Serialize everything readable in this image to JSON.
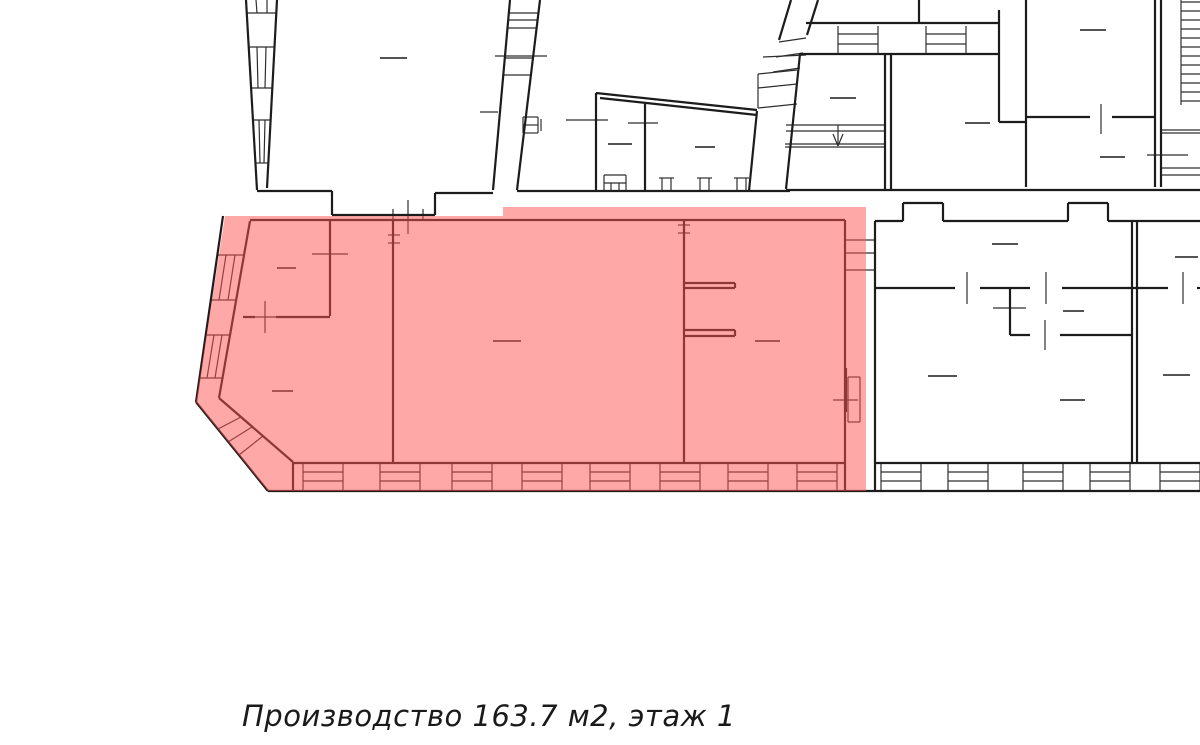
{
  "caption": {
    "text": "Производство 163.7 м2, этаж 1"
  },
  "colors": {
    "background": "#ffffff",
    "wall": "#1c1c1c",
    "thin_line": "#2e2e2e",
    "highlight": "#ff5252",
    "highlight_opacity": 0.5
  },
  "floorplan": {
    "width": 1200,
    "height": 745,
    "highlight_polygon": [
      [
        225,
        216
      ],
      [
        503,
        216
      ],
      [
        503,
        207
      ],
      [
        866,
        207
      ],
      [
        866,
        491
      ],
      [
        268,
        491
      ],
      [
        196,
        402
      ]
    ],
    "thick": [
      [
        246,
        0,
        257,
        190
      ],
      [
        277,
        0,
        267,
        188
      ],
      [
        257,
        191,
        332,
        191
      ],
      [
        332,
        191,
        332,
        215
      ],
      [
        332,
        215,
        435,
        215
      ],
      [
        435,
        215,
        435,
        193
      ],
      [
        435,
        193,
        493,
        193
      ],
      [
        510,
        0,
        493,
        190
      ],
      [
        540,
        0,
        517,
        190
      ],
      [
        517,
        191,
        790,
        191
      ],
      [
        596,
        93,
        596,
        191
      ],
      [
        596,
        93,
        757,
        110
      ],
      [
        600,
        98,
        757,
        115
      ],
      [
        645,
        104,
        645,
        191
      ],
      [
        757,
        111,
        749,
        191
      ],
      [
        800,
        54,
        786,
        189
      ],
      [
        885,
        54,
        885,
        189
      ],
      [
        891,
        54,
        891,
        189
      ],
      [
        806,
        23,
        999,
        23
      ],
      [
        800,
        54,
        999,
        54
      ],
      [
        919,
        0,
        919,
        23
      ],
      [
        999,
        10,
        999,
        122
      ],
      [
        999,
        122,
        1026,
        122
      ],
      [
        1026,
        0,
        1026,
        187
      ],
      [
        1026,
        117,
        1090,
        117
      ],
      [
        1112,
        117,
        1155,
        117
      ],
      [
        1155,
        0,
        1155,
        187
      ],
      [
        1161,
        0,
        1161,
        187
      ],
      [
        786,
        190,
        1200,
        190
      ],
      [
        791,
        0,
        779,
        40
      ],
      [
        818,
        0,
        807,
        35
      ],
      [
        875,
        221,
        903,
        221
      ],
      [
        903,
        221,
        903,
        203
      ],
      [
        903,
        203,
        943,
        203
      ],
      [
        943,
        203,
        943,
        221
      ],
      [
        943,
        221,
        1068,
        221
      ],
      [
        1068,
        221,
        1068,
        203
      ],
      [
        1068,
        203,
        1108,
        203
      ],
      [
        1108,
        203,
        1108,
        221
      ],
      [
        1108,
        221,
        1200,
        221
      ],
      [
        875,
        221,
        875,
        463
      ],
      [
        1132,
        221,
        1132,
        463
      ],
      [
        1137,
        221,
        1137,
        463
      ],
      [
        875,
        288,
        955,
        288
      ],
      [
        980,
        288,
        1030,
        288
      ],
      [
        1062,
        288,
        1168,
        288
      ],
      [
        1197,
        288,
        1200,
        288
      ],
      [
        1010,
        288,
        1010,
        335
      ],
      [
        1010,
        335,
        1030,
        335
      ],
      [
        1060,
        335,
        1132,
        335
      ],
      [
        250,
        220,
        845,
        220
      ],
      [
        250,
        221,
        219,
        398
      ],
      [
        219,
        398,
        293,
        462
      ],
      [
        293,
        462,
        293,
        491
      ],
      [
        293,
        463,
        845,
        463
      ],
      [
        875,
        463,
        1200,
        463
      ],
      [
        845,
        220,
        845,
        463
      ],
      [
        393,
        220,
        393,
        463
      ],
      [
        684,
        220,
        684,
        463
      ],
      [
        330,
        220,
        330,
        316
      ],
      [
        243,
        317,
        255,
        317
      ],
      [
        276,
        317,
        330,
        317
      ],
      [
        684,
        283,
        735,
        283
      ],
      [
        684,
        288,
        735,
        288
      ],
      [
        735,
        283,
        735,
        288
      ],
      [
        684,
        330,
        735,
        330
      ],
      [
        684,
        336,
        735,
        336
      ],
      [
        735,
        330,
        735,
        336
      ],
      [
        223,
        216,
        196,
        402
      ],
      [
        196,
        402,
        268,
        491
      ],
      [
        268,
        491,
        1200,
        491
      ],
      [
        845,
        463,
        845,
        491
      ],
      [
        875,
        463,
        875,
        491
      ],
      [
        846,
        368,
        846,
        412
      ]
    ],
    "thin": [
      [
        247,
        13,
        276,
        13
      ],
      [
        256,
        0,
        257,
        13
      ],
      [
        267,
        0,
        267,
        13
      ],
      [
        249,
        47,
        274,
        47
      ],
      [
        251,
        88,
        272,
        88
      ],
      [
        257,
        47,
        258,
        88
      ],
      [
        266,
        47,
        265,
        88
      ],
      [
        253,
        120,
        271,
        120
      ],
      [
        255,
        163,
        268,
        163
      ],
      [
        259,
        120,
        260,
        163
      ],
      [
        265,
        120,
        264,
        163
      ],
      [
        509,
        13,
        538,
        13
      ],
      [
        508,
        20,
        537,
        20
      ],
      [
        507,
        28,
        537,
        28
      ],
      [
        495,
        56,
        547,
        56
      ],
      [
        505,
        58,
        533,
        58
      ],
      [
        503,
        75,
        531,
        75
      ],
      [
        523,
        117,
        538,
        117
      ],
      [
        538,
        117,
        538,
        133
      ],
      [
        523,
        133,
        538,
        133
      ],
      [
        523,
        117,
        523,
        133
      ],
      [
        523,
        125,
        538,
        125
      ],
      [
        541,
        119,
        541,
        131
      ],
      [
        480,
        112,
        498,
        112
      ],
      [
        217,
        255,
        244,
        255
      ],
      [
        211,
        300,
        236,
        300
      ],
      [
        226,
        255,
        219,
        300
      ],
      [
        235,
        255,
        228,
        300
      ],
      [
        206,
        335,
        230,
        335
      ],
      [
        200,
        378,
        223,
        378
      ],
      [
        214,
        335,
        207,
        378
      ],
      [
        222,
        335,
        215,
        378
      ],
      [
        218,
        429,
        241,
        417
      ],
      [
        228,
        442,
        252,
        427
      ],
      [
        239,
        455,
        263,
        436
      ],
      [
        303,
        463,
        303,
        491
      ],
      [
        343,
        463,
        343,
        491
      ],
      [
        303,
        472,
        343,
        472
      ],
      [
        303,
        481,
        343,
        481
      ],
      [
        380,
        463,
        380,
        491
      ],
      [
        420,
        463,
        420,
        491
      ],
      [
        380,
        472,
        420,
        472
      ],
      [
        380,
        481,
        420,
        481
      ],
      [
        452,
        463,
        452,
        491
      ],
      [
        492,
        463,
        492,
        491
      ],
      [
        452,
        472,
        492,
        472
      ],
      [
        452,
        481,
        492,
        481
      ],
      [
        522,
        463,
        522,
        491
      ],
      [
        562,
        463,
        562,
        491
      ],
      [
        522,
        472,
        562,
        472
      ],
      [
        522,
        481,
        562,
        481
      ],
      [
        590,
        463,
        590,
        491
      ],
      [
        630,
        463,
        630,
        491
      ],
      [
        590,
        472,
        630,
        472
      ],
      [
        590,
        481,
        630,
        481
      ],
      [
        660,
        463,
        660,
        491
      ],
      [
        700,
        463,
        700,
        491
      ],
      [
        660,
        472,
        700,
        472
      ],
      [
        660,
        481,
        700,
        481
      ],
      [
        728,
        463,
        728,
        491
      ],
      [
        768,
        463,
        768,
        491
      ],
      [
        728,
        472,
        768,
        472
      ],
      [
        728,
        481,
        768,
        481
      ],
      [
        797,
        463,
        797,
        491
      ],
      [
        837,
        463,
        837,
        491
      ],
      [
        797,
        472,
        837,
        472
      ],
      [
        797,
        481,
        837,
        481
      ],
      [
        881,
        463,
        881,
        491
      ],
      [
        921,
        463,
        921,
        491
      ],
      [
        881,
        472,
        921,
        472
      ],
      [
        881,
        481,
        921,
        481
      ],
      [
        948,
        463,
        948,
        491
      ],
      [
        988,
        463,
        988,
        491
      ],
      [
        948,
        472,
        988,
        472
      ],
      [
        948,
        481,
        988,
        481
      ],
      [
        1023,
        463,
        1023,
        491
      ],
      [
        1063,
        463,
        1063,
        491
      ],
      [
        1023,
        472,
        1063,
        472
      ],
      [
        1023,
        481,
        1063,
        481
      ],
      [
        1090,
        463,
        1090,
        491
      ],
      [
        1130,
        463,
        1130,
        491
      ],
      [
        1090,
        472,
        1130,
        472
      ],
      [
        1090,
        481,
        1130,
        481
      ],
      [
        1160,
        463,
        1160,
        491
      ],
      [
        1200,
        463,
        1200,
        491
      ],
      [
        1160,
        472,
        1200,
        472
      ],
      [
        1160,
        481,
        1200,
        481
      ],
      [
        786,
        125,
        885,
        125
      ],
      [
        786,
        131,
        885,
        131
      ],
      [
        785,
        144,
        885,
        144
      ],
      [
        785,
        147,
        885,
        147
      ],
      [
        838,
        125,
        838,
        145
      ],
      [
        833,
        134,
        838,
        146
      ],
      [
        843,
        134,
        838,
        146
      ],
      [
        758,
        74,
        797,
        70
      ],
      [
        758,
        88,
        797,
        84
      ],
      [
        758,
        108,
        797,
        104
      ],
      [
        758,
        74,
        758,
        108
      ],
      [
        779,
        42,
        806,
        38
      ],
      [
        776,
        57,
        803,
        53
      ],
      [
        773,
        72,
        800,
        68
      ],
      [
        838,
        26,
        838,
        54
      ],
      [
        878,
        26,
        878,
        54
      ],
      [
        838,
        34,
        878,
        34
      ],
      [
        838,
        44,
        878,
        44
      ],
      [
        926,
        26,
        926,
        54
      ],
      [
        966,
        26,
        966,
        54
      ],
      [
        926,
        34,
        966,
        34
      ],
      [
        926,
        44,
        966,
        44
      ],
      [
        763,
        57,
        806,
        55
      ],
      [
        659,
        178,
        674,
        178
      ],
      [
        662,
        178,
        662,
        190
      ],
      [
        671,
        178,
        671,
        190
      ],
      [
        697,
        178,
        712,
        178
      ],
      [
        700,
        178,
        700,
        190
      ],
      [
        709,
        178,
        709,
        190
      ],
      [
        734,
        178,
        749,
        178
      ],
      [
        737,
        178,
        737,
        190
      ],
      [
        746,
        178,
        746,
        190
      ],
      [
        604,
        175,
        626,
        175
      ],
      [
        604,
        175,
        604,
        190
      ],
      [
        626,
        175,
        626,
        190
      ],
      [
        604,
        183,
        626,
        183
      ],
      [
        611,
        183,
        611,
        190
      ],
      [
        619,
        183,
        619,
        190
      ],
      [
        408,
        200,
        408,
        234
      ],
      [
        393,
        209,
        393,
        221
      ],
      [
        423,
        209,
        423,
        221
      ],
      [
        265,
        301,
        265,
        333
      ],
      [
        248,
        317,
        283,
        317
      ],
      [
        312,
        254,
        348,
        254
      ],
      [
        566,
        120,
        608,
        120
      ],
      [
        628,
        123,
        658,
        123
      ],
      [
        1101,
        104,
        1101,
        134
      ],
      [
        1147,
        155,
        1188,
        155
      ],
      [
        967,
        272,
        967,
        304
      ],
      [
        1046,
        272,
        1046,
        304
      ],
      [
        1183,
        272,
        1183,
        304
      ],
      [
        993,
        308,
        1026,
        308
      ],
      [
        1045,
        320,
        1045,
        350
      ],
      [
        833,
        400,
        858,
        400
      ],
      [
        388,
        235,
        400,
        235
      ],
      [
        388,
        243,
        400,
        243
      ],
      [
        678,
        225,
        690,
        225
      ],
      [
        678,
        233,
        690,
        233
      ],
      [
        845,
        240,
        875,
        240
      ],
      [
        845,
        253,
        875,
        253
      ],
      [
        845,
        270,
        875,
        270
      ],
      [
        848,
        377,
        860,
        377
      ],
      [
        860,
        377,
        860,
        422
      ],
      [
        848,
        422,
        860,
        422
      ],
      [
        848,
        377,
        848,
        422
      ],
      [
        1181,
        0,
        1181,
        105
      ],
      [
        1181,
        2,
        1200,
        2
      ],
      [
        1181,
        11,
        1200,
        11
      ],
      [
        1181,
        20,
        1200,
        20
      ],
      [
        1181,
        29,
        1200,
        29
      ],
      [
        1181,
        38,
        1200,
        38
      ],
      [
        1181,
        47,
        1200,
        47
      ],
      [
        1181,
        56,
        1200,
        56
      ],
      [
        1181,
        65,
        1200,
        65
      ],
      [
        1181,
        74,
        1200,
        74
      ],
      [
        1181,
        83,
        1200,
        83
      ],
      [
        1181,
        92,
        1200,
        92
      ],
      [
        1181,
        101,
        1200,
        101
      ],
      [
        1161,
        130,
        1200,
        130
      ],
      [
        1161,
        133,
        1200,
        133
      ],
      [
        1161,
        168,
        1200,
        168
      ],
      [
        1161,
        175,
        1200,
        175
      ]
    ],
    "room_dashes": [
      [
        380,
        58,
        407,
        58
      ],
      [
        608,
        144,
        632,
        144
      ],
      [
        695,
        147,
        715,
        147
      ],
      [
        830,
        98,
        856,
        98
      ],
      [
        965,
        123,
        990,
        123
      ],
      [
        1080,
        30,
        1106,
        30
      ],
      [
        1100,
        157,
        1125,
        157
      ],
      [
        277,
        268,
        296,
        268
      ],
      [
        272,
        391,
        293,
        391
      ],
      [
        493,
        341,
        521,
        341
      ],
      [
        755,
        341,
        780,
        341
      ],
      [
        992,
        244,
        1018,
        244
      ],
      [
        1175,
        257,
        1198,
        257
      ],
      [
        1063,
        311,
        1084,
        311
      ],
      [
        928,
        376,
        957,
        376
      ],
      [
        1060,
        400,
        1085,
        400
      ],
      [
        1163,
        375,
        1190,
        375
      ]
    ]
  }
}
